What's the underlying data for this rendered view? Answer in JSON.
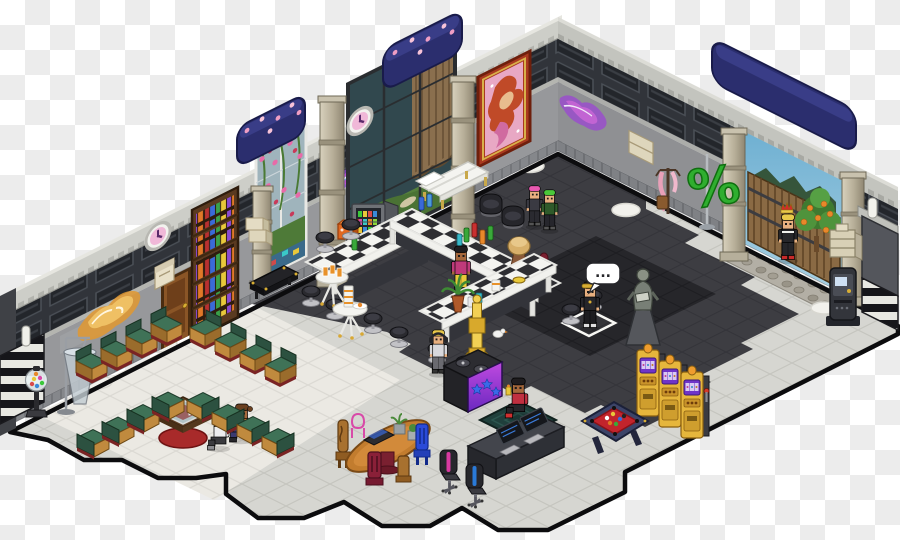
{
  "meta": {
    "description": "Isometric pixel-art hotel club room rendered on a transparency checkerboard",
    "canvas": {
      "width": 900,
      "height": 540
    }
  },
  "background": {
    "checker_colors": [
      "#ffffff",
      "#ececec"
    ],
    "checker_size": 25
  },
  "speech_bubble": {
    "text": "...",
    "owner": "gold-wreath-avatar"
  },
  "sculpture_sign": {
    "glyph": "%"
  },
  "palette": {
    "banner_navy": "#2b2e6e",
    "wall_stone": "#97989b",
    "vent_band": "#31343a",
    "coping": "#cdcec8",
    "floor_dark": "#3d3d42",
    "floor_dance": "#26262a",
    "floor_light": "#d6d6d1",
    "floor_lounge": "#ebe9e3",
    "counter_check": "#2e2e32",
    "counter_white": "#f4f4f0",
    "sofa_green": "#3f7257",
    "sofa_wood": "#c08a3e",
    "slot_gold": "#e6b63c",
    "dj_purple": "#a336d6",
    "pool_felt": "#c2242c",
    "sky": "#7ab6d4",
    "orange_fruit": "#e8882a"
  },
  "objects": [
    {
      "name": "navy-awning-left",
      "description": "navy rounded awning with pink blossoms on wall top",
      "position": [
        237,
        108
      ]
    },
    {
      "name": "navy-awning-center",
      "description": "navy rounded awning with pink blossoms",
      "position": [
        383,
        30
      ]
    },
    {
      "name": "navy-awning-gate",
      "description": "long navy awning above garden gate",
      "position": [
        710,
        88
      ]
    },
    {
      "name": "rose-window",
      "description": "tall white-framed window covered in rose vines, aquarium mosaic at bottom",
      "position": [
        256,
        138
      ]
    },
    {
      "name": "terrarium-window",
      "description": "tall dark-framed window with brown curtain, grass and stepping stones",
      "position": [
        348,
        58
      ]
    },
    {
      "name": "mermaid-painting",
      "description": "large red-framed painting of red-haired mermaid on pink",
      "position": [
        476,
        62
      ]
    },
    {
      "name": "wall-clock-left",
      "description": "round clock with pink face",
      "position": [
        148,
        226
      ]
    },
    {
      "name": "wall-clock-center",
      "description": "round clock with pink face",
      "position": [
        348,
        107
      ]
    },
    {
      "name": "graffiti-gold",
      "description": "gold-orange spray graffiti on stone wall",
      "position": [
        75,
        288
      ]
    },
    {
      "name": "graffiti-purple-left",
      "description": "purple-cyan spray graffiti",
      "position": [
        330,
        156
      ]
    },
    {
      "name": "graffiti-purple-right",
      "description": "purple graffiti on right wall",
      "position": [
        558,
        106
      ]
    },
    {
      "name": "wooden-door",
      "description": "brown wooden door in left wall",
      "position": [
        162,
        276
      ]
    },
    {
      "name": "bookshelf",
      "description": "tall dark-wood bookcase full of colorful books",
      "position": [
        192,
        206
      ]
    },
    {
      "name": "wall-letterbox",
      "description": "beige letterbox on wall",
      "position": [
        155,
        264
      ]
    },
    {
      "name": "storage-boxes",
      "description": "two beige boxes by window pillar",
      "position": [
        245,
        216
      ]
    },
    {
      "name": "wall-shelf-right",
      "description": "beige box shelf on right wall",
      "position": [
        628,
        134
      ]
    },
    {
      "name": "coat-stand",
      "description": "wooden coat stand with pink scarf and satchel",
      "position": [
        656,
        164
      ]
    },
    {
      "name": "percent-sculpture",
      "description": "large green percent-sign sculpture on pole",
      "position": [
        690,
        150
      ]
    },
    {
      "name": "garden-gate",
      "description": "open gate with blue sky, wooden picket fence and cobblestone path",
      "position": [
        722,
        128
      ]
    },
    {
      "name": "orange-tree",
      "description": "small orange tree inside gate",
      "position": [
        798,
        190
      ]
    },
    {
      "name": "stone-pillars",
      "description": "five banded beige stone columns",
      "position": [
        253,
        75
      ]
    },
    {
      "name": "beige-cabinet-right",
      "description": "modern beige shelf unit",
      "position": [
        830,
        228
      ]
    },
    {
      "name": "atm-machine",
      "description": "dark ATM/jukebox cabinet",
      "position": [
        828,
        266
      ]
    },
    {
      "name": "drinks-fridge",
      "description": "glass-front drinks cooler with colorful cans",
      "position": [
        352,
        196
      ]
    },
    {
      "name": "mini-fridge-orange",
      "description": "small orange counter machine",
      "position": [
        338,
        220
      ]
    },
    {
      "name": "black-coffee-table",
      "description": "low black table with gold corners",
      "position": [
        248,
        266
      ]
    },
    {
      "name": "white-bench-bed",
      "description": "white bench with gold legs by window",
      "position": [
        418,
        162
      ]
    },
    {
      "name": "bar-counter-u",
      "description": "U-shaped bar of black/white checkered counters",
      "position": [
        306,
        209
      ]
    },
    {
      "name": "counter-lamp",
      "description": "beige dome table lamp on counter",
      "position": [
        508,
        232
      ]
    },
    {
      "name": "counter-bottles",
      "description": "green/red/blue bottles and cans on counters",
      "position": [
        460,
        222
      ]
    },
    {
      "name": "potted-palm",
      "description": "terracotta potted palm on counter",
      "position": [
        448,
        276
      ]
    },
    {
      "name": "round-table-juice",
      "description": "white pedestal table with orange juice glasses",
      "position": [
        318,
        266
      ]
    },
    {
      "name": "round-table-cups",
      "description": "white pedestal table with stacked cups and plate",
      "position": [
        335,
        286
      ]
    },
    {
      "name": "bar-stools",
      "description": "black round bar stools on chrome pedestals",
      "position": [
        300,
        220
      ]
    },
    {
      "name": "tub-chairs",
      "description": "two black tub chairs near corner",
      "position": [
        480,
        194
      ]
    },
    {
      "name": "dj-booth",
      "description": "black DJ turntable booth with purple star-lit front",
      "position": [
        444,
        350
      ]
    },
    {
      "name": "gold-trophy-tower",
      "description": "stacked golden trophy column",
      "position": [
        462,
        292
      ]
    },
    {
      "name": "dance-rug",
      "description": "dark teal patterned rug",
      "position": [
        480,
        401
      ]
    },
    {
      "name": "floor-tile-marker",
      "description": "white selected-tile outline on dance floor",
      "position": [
        563,
        310
      ]
    },
    {
      "name": "gargoyle-statue",
      "description": "stone gargoyle reading a book on pedestal",
      "position": [
        622,
        262
      ]
    },
    {
      "name": "slot-machines",
      "description": "three golden slot machines with purple reels",
      "position": [
        636,
        342
      ]
    },
    {
      "name": "pool-table",
      "description": "red-felt billiard table with colored balls",
      "position": [
        578,
        398
      ]
    },
    {
      "name": "computer-desk",
      "description": "dark desk with two monitors and keyboards",
      "position": [
        468,
        410
      ]
    },
    {
      "name": "office-chair-pink",
      "description": "black office chair with pink stripe",
      "position": [
        438,
        452
      ]
    },
    {
      "name": "office-chair-blue",
      "description": "black office chair with blue stripe",
      "position": [
        464,
        466
      ]
    },
    {
      "name": "dining-table",
      "description": "oval wooden table with laptop and two potted succulents",
      "position": [
        344,
        424
      ]
    },
    {
      "name": "dining-chairs",
      "description": "tall wood chair, pink wire chair, blue chair, maroon chair",
      "position": [
        326,
        404
      ]
    },
    {
      "name": "sofa-lounge",
      "description": "four rows of green-cushion wooden sofas around display table",
      "position": [
        75,
        314
      ]
    },
    {
      "name": "display-table",
      "description": "glass-top display table with red round base",
      "position": [
        150,
        392
      ]
    },
    {
      "name": "floor-lamp",
      "description": "gray cone floor lamp",
      "position": [
        56,
        334
      ]
    },
    {
      "name": "gumball-machine",
      "description": "gumball machine with colorful balls",
      "position": [
        24,
        366
      ]
    },
    {
      "name": "white-round-rugs",
      "description": "five white oval floor mats",
      "position": [
        78,
        332
      ]
    },
    {
      "name": "pigeon",
      "description": "small white pigeon on floor",
      "position": [
        494,
        332
      ]
    },
    {
      "name": "floor-cocktail",
      "description": "small yellow drink on floor near rug",
      "position": [
        506,
        384
      ]
    },
    {
      "name": "striped-wall-ends",
      "description": "black/white striped wall end corners",
      "position": [
        0,
        330
      ]
    }
  ],
  "avatars": [
    {
      "name": "dj-avatar",
      "appearance": "blond hair, headphones, light shirt",
      "position": [
        427,
        328
      ],
      "activity": "mixing at DJ booth"
    },
    {
      "name": "barista-pink-hair",
      "appearance": "pink hair, dark top",
      "position": [
        526,
        184
      ],
      "activity": "standing behind bar"
    },
    {
      "name": "barista-green-hair",
      "appearance": "green hair, dark green top",
      "position": [
        541,
        188
      ],
      "activity": "standing behind bar"
    },
    {
      "name": "bartender-girl",
      "appearance": "dark skin, black hair, magenta jacket, yellow pants",
      "position": [
        449,
        244
      ],
      "activity": "inside bar U"
    },
    {
      "name": "rug-sitter-girl",
      "appearance": "dark skin, black hair, red top, red shoes",
      "position": [
        505,
        376
      ],
      "activity": "sitting on rug"
    },
    {
      "name": "gold-wreath-guy",
      "appearance": "black outfit, gold laurel wreath, white sneakers",
      "position": [
        578,
        280
      ],
      "activity": "standing on marked tile, speech bubble"
    },
    {
      "name": "king-at-gate",
      "appearance": "red-gold crown, blond hair, black suit, red shoes",
      "position": [
        776,
        208
      ],
      "activity": "standing on cobblestone path"
    },
    {
      "name": "sofa-sitter-gray",
      "appearance": "gray curly hair, white shirt",
      "position": [
        206,
        412
      ],
      "activity": "sitting on sofa"
    },
    {
      "name": "sofa-sitter-orange",
      "appearance": "brown pigtails, orange shirt",
      "position": [
        228,
        404
      ],
      "activity": "sitting on sofa"
    }
  ],
  "counts": {
    "slot_machines": 3,
    "bar_stools": 11,
    "tub_chairs": 2,
    "sofa_seats": 16,
    "round_tables": 2,
    "wall_clocks": 2,
    "navy_banners": 3,
    "monitors": 2,
    "office_chairs": 2,
    "white_round_rugs": 5,
    "graffiti_pieces": 3,
    "stone_pillars": 5
  }
}
